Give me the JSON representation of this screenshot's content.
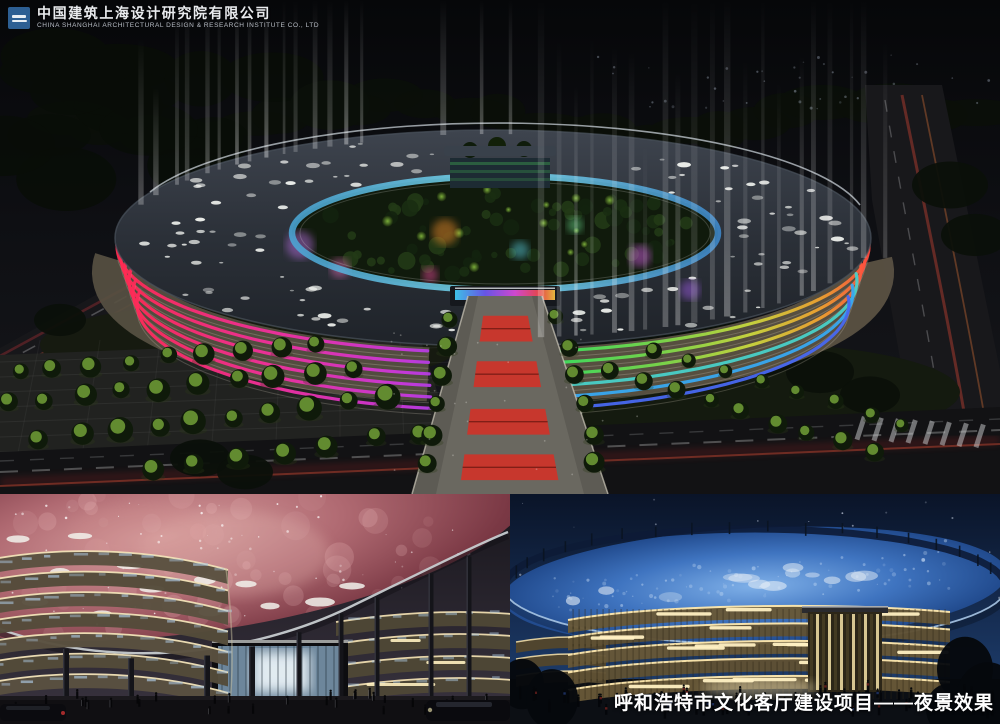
{
  "header": {
    "company_name_cn": "中国建筑上海设计研究院有限公司",
    "company_name_en": "CHINA SHANGHAI ARCHITECTURAL DESIGN & RESEARCH INSTITUTE CO., LTD"
  },
  "caption": {
    "text": "呼和浩特市文化客厅建设项目——夜景效果"
  },
  "panels": {
    "main_aerial": "aerial-night-rendering",
    "street_nebula": "street-night-rendering-red-nebula-canopy",
    "street_blue": "street-night-rendering-blue-star-canopy"
  },
  "colors": {
    "logo_blue": "#2d5f93",
    "caption_white": "#ffffff",
    "led_red": "#ff2a4e",
    "led_magenta": "#f030a0",
    "led_purple": "#c838e0",
    "led_blue": "#4a58f0",
    "led_cyan": "#3fc8f0",
    "led_green": "#38e060",
    "led_orange": "#f0a030",
    "clerestory_cyan": "#7ee0f4",
    "nebula_canopy": "#b06a72",
    "star_canopy": "#3f74c0",
    "facade_gold": "#ffe9ae",
    "carpet_red": "#d23228"
  }
}
